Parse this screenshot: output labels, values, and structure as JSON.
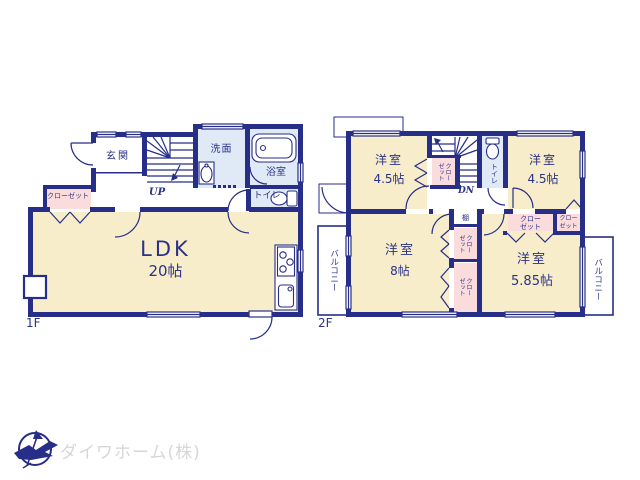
{
  "palette": {
    "wall": "#272e87",
    "room_fill": "#f8edcb",
    "closet_fill": "#fbdcdc",
    "wet_fill": "#e0eaf6",
    "line": "#272e87",
    "text": "#2b3287",
    "logo_text": "#d7d7d7",
    "logo_mark": "#272e87",
    "bg": "#ffffff"
  },
  "floor1": {
    "label": "1F",
    "entrance": "玄関",
    "stairs": "UP",
    "washroom": "洗面",
    "bathroom": "浴室",
    "toilet": "トイレ",
    "closet": "クローゼット",
    "ldk": {
      "name": "LDK",
      "size": "20帖"
    }
  },
  "floor2": {
    "label": "2F",
    "stairs": "DN",
    "toilet": "トイレ",
    "shelf": "棚",
    "balcony_left": "バルコニー",
    "balcony_right": "バルコニー",
    "stair_closet": "クローゼット",
    "mid_closet_upper": "クローゼット",
    "mid_closet_lower": "クローゼット",
    "tr_closet_wide": "クローゼット",
    "tr_closet_narrow": "クローゼット",
    "room_nw": {
      "name": "洋室",
      "size": "4.5帖"
    },
    "room_ne": {
      "name": "洋室",
      "size": "4.5帖"
    },
    "room_sw": {
      "name": "洋室",
      "size": "8帖"
    },
    "room_se": {
      "name": "洋室",
      "size": "5.85帖"
    }
  },
  "logo": {
    "company": "ダイワホーム(株)"
  }
}
